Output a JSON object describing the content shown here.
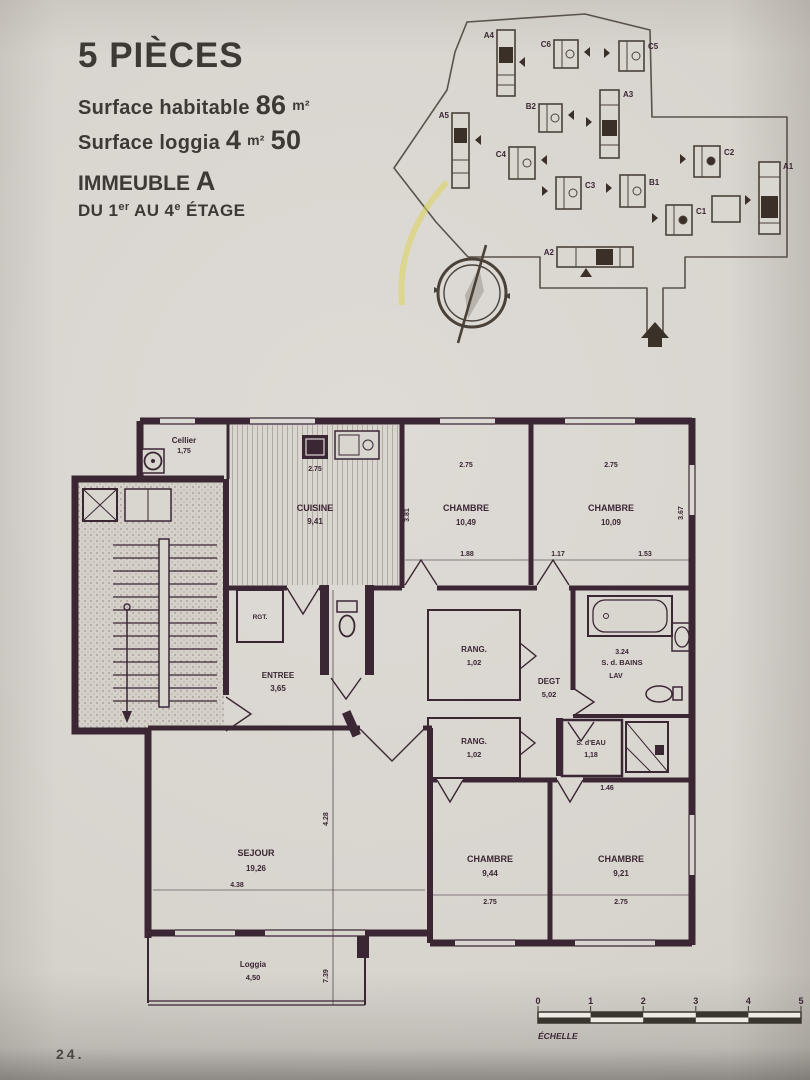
{
  "header": {
    "title": "5 PIÈCES",
    "surface_habitable_label": "Surface habitable",
    "surface_habitable_value": "86",
    "surface_habitable_unit": "m²",
    "surface_loggia_label": "Surface loggia",
    "surface_loggia_value": "4",
    "surface_loggia_unit": "m²",
    "surface_loggia_extra": "50",
    "immeuble_label": "IMMEUBLE",
    "immeuble_value": "A",
    "etage": {
      "p1": "DU 1",
      "s1": "er",
      "p2": " AU 4",
      "s2": "e",
      "p3": " ÉTAGE"
    }
  },
  "site": {
    "buildings": [
      {
        "label": "A4"
      },
      {
        "label": "C6"
      },
      {
        "label": "C5"
      },
      {
        "label": "A5"
      },
      {
        "label": "B2"
      },
      {
        "label": "A3"
      },
      {
        "label": "C4"
      },
      {
        "label": "C3"
      },
      {
        "label": "B1"
      },
      {
        "label": "C2"
      },
      {
        "label": "C1"
      },
      {
        "label": "A1"
      },
      {
        "label": "A2"
      }
    ]
  },
  "plan": {
    "rooms": [
      {
        "name": "Cellier",
        "area": "1,75"
      },
      {
        "name": "CUISINE",
        "area": "9,41"
      },
      {
        "name": "CHAMBRE",
        "area": "10,49"
      },
      {
        "name": "CHAMBRE",
        "area": "10,09"
      },
      {
        "name": "ENTREE",
        "area": "3,65"
      },
      {
        "name": "RANG.",
        "area": "1,02"
      },
      {
        "name": "DEGT",
        "area": "5,02"
      },
      {
        "dim": "3.24",
        "name": "S. d. BAINS",
        "sub": "LAV"
      },
      {
        "name": "RANG.",
        "area": "1,02"
      },
      {
        "name": "S. d'EAU",
        "area": "1,18"
      },
      {
        "name": "SEJOUR",
        "area": "19,26"
      },
      {
        "name": "CHAMBRE",
        "area": "9,44"
      },
      {
        "name": "CHAMBRE",
        "area": "9,21"
      },
      {
        "name": "Loggia",
        "area": "4,50"
      },
      {
        "name": "RGT."
      }
    ],
    "dims": [
      "2.75",
      "2.75",
      "2.75",
      "1.88",
      "1.17",
      "1.53",
      "3.81",
      "3.67",
      "1.46",
      "4.38",
      "2.75",
      "2.75",
      "4.28",
      "7.39"
    ]
  },
  "scale": {
    "numbers": [
      "0",
      "1",
      "2",
      "3",
      "4",
      "5"
    ],
    "label": "ÉCHELLE"
  },
  "page": {
    "number": "24."
  }
}
